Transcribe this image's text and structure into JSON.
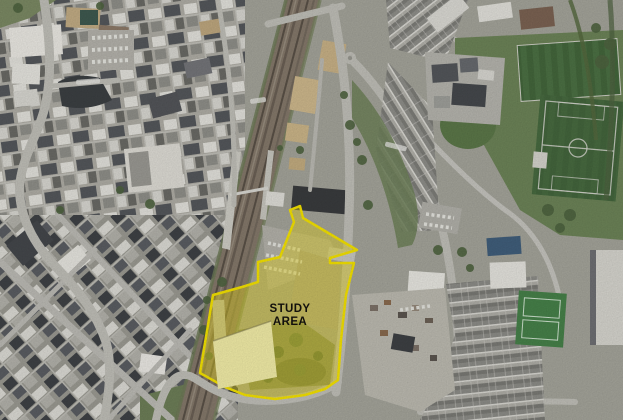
{
  "figure": {
    "type": "aerial-photograph",
    "description": "Aerial photograph of a town centre with railway corridor, sports pitches and a highlighted study area boundary",
    "annotation": {
      "label_line1": "STUDY",
      "label_line2": "AREA",
      "label_color": "#14120e",
      "outline_color": "#f6e400",
      "outline_width": "2.5",
      "fill_color": "#ead921",
      "fill_opacity": "0.45",
      "solid_fill_color": "#f3eea8",
      "outline_points": "290,210 300,206 303,218 357,250 330,258 330,263 354,263 346,295 341,340 338,380 325,389 305,395 275,399 245,395 225,387 200,373 213,295 242,287 258,282 258,262 280,257 294,222",
      "solid_fill_points": "213,341 271,321 277,377 218,389",
      "excluded_parcel": "building excluded from boundary"
    }
  }
}
